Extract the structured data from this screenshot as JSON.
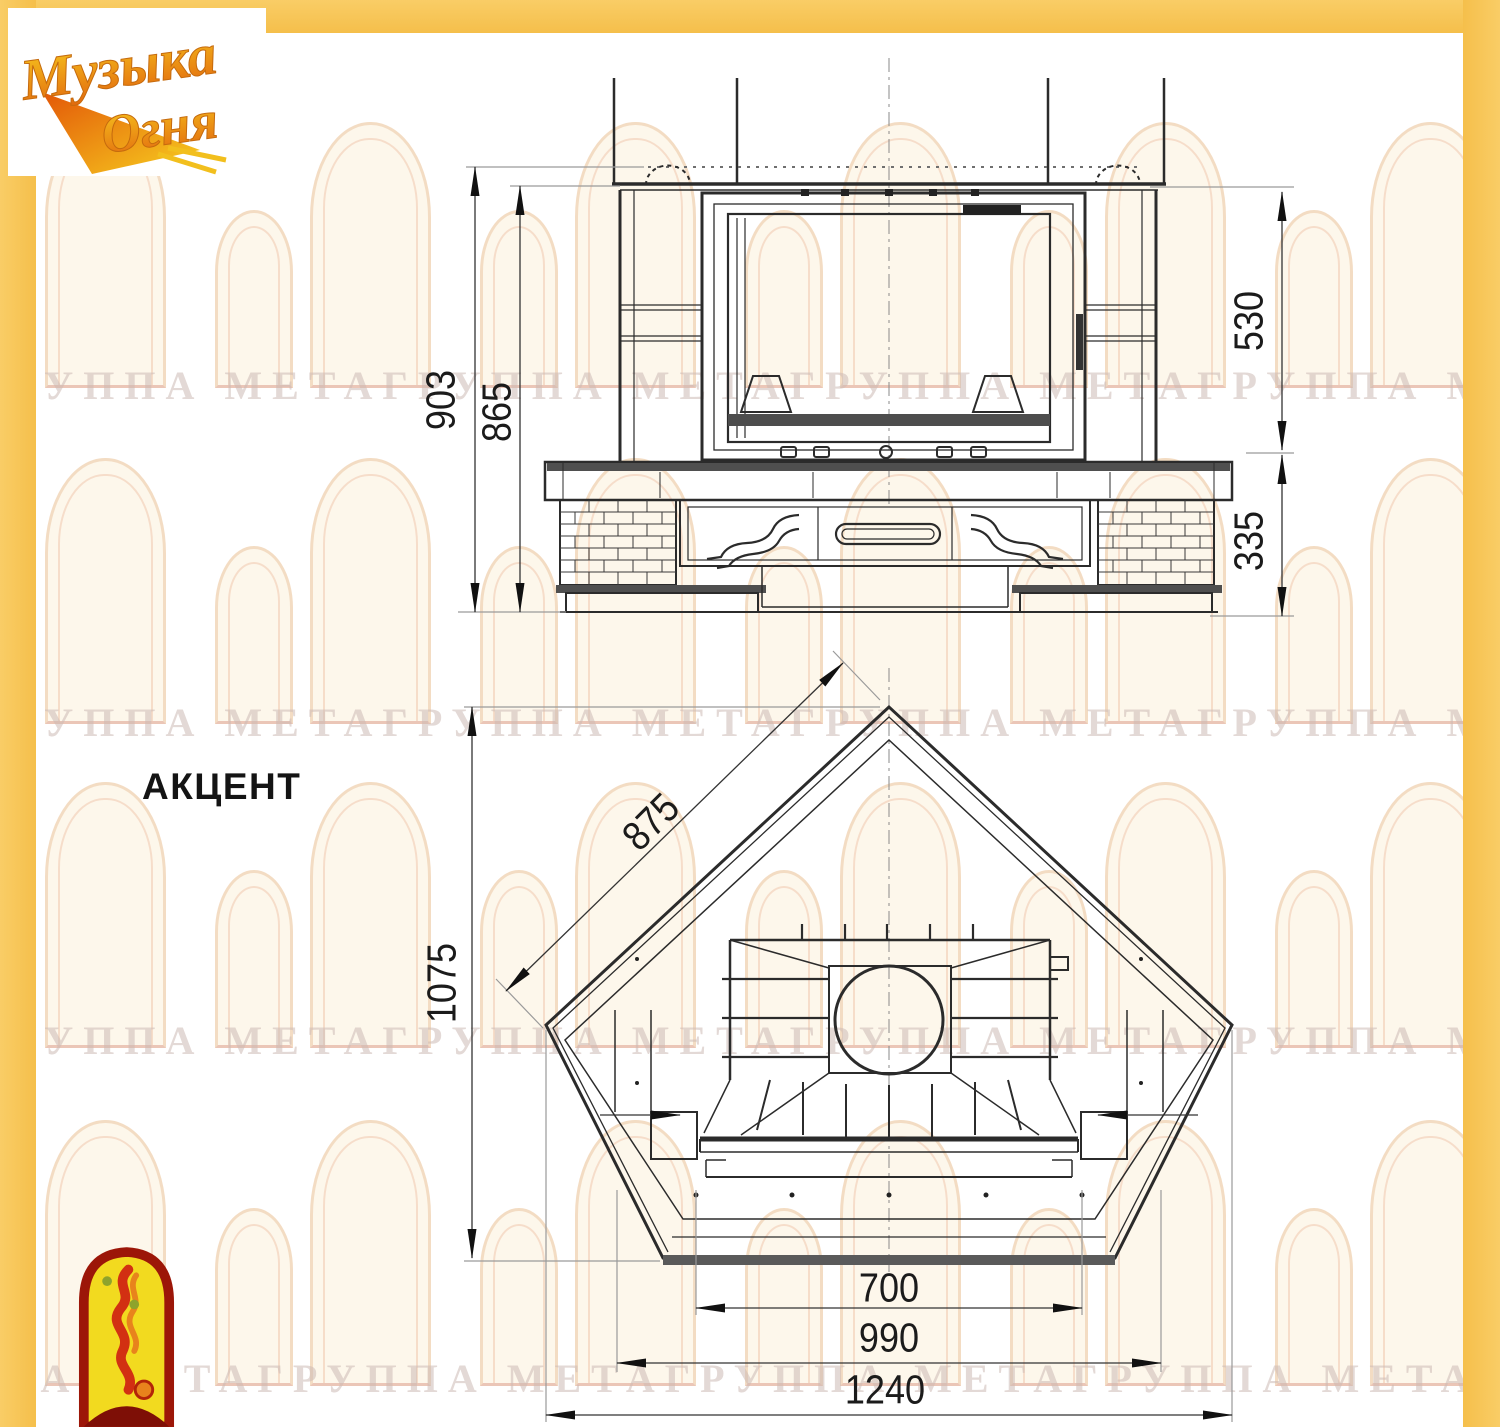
{
  "logo": {
    "line1": "Музыка",
    "line2": "Огня"
  },
  "model": {
    "label": "АКЦЕНТ"
  },
  "watermark": {
    "text": "ГРУППА МЕТАГРУППА МЕТАГРУППА МЕТАГРУППА МЕТА"
  },
  "dims": {
    "front": {
      "overall_height": "903",
      "portal_height": "865",
      "upper_height": "530",
      "base_height": "335"
    },
    "plan": {
      "side_depth": "875",
      "total_depth": "1075",
      "glass_width": "700",
      "inner_width": "990",
      "overall_width": "1240"
    }
  },
  "colors": {
    "frame_yellow": "#f8c85f",
    "drawing_line": "#2b2b2b",
    "dim_text": "#1b1b1b",
    "watermark_tint": "#cebab5",
    "emblem_red": "#9c1608",
    "emblem_yellow": "#f2da1f",
    "logo_orange": "#e2690e"
  }
}
